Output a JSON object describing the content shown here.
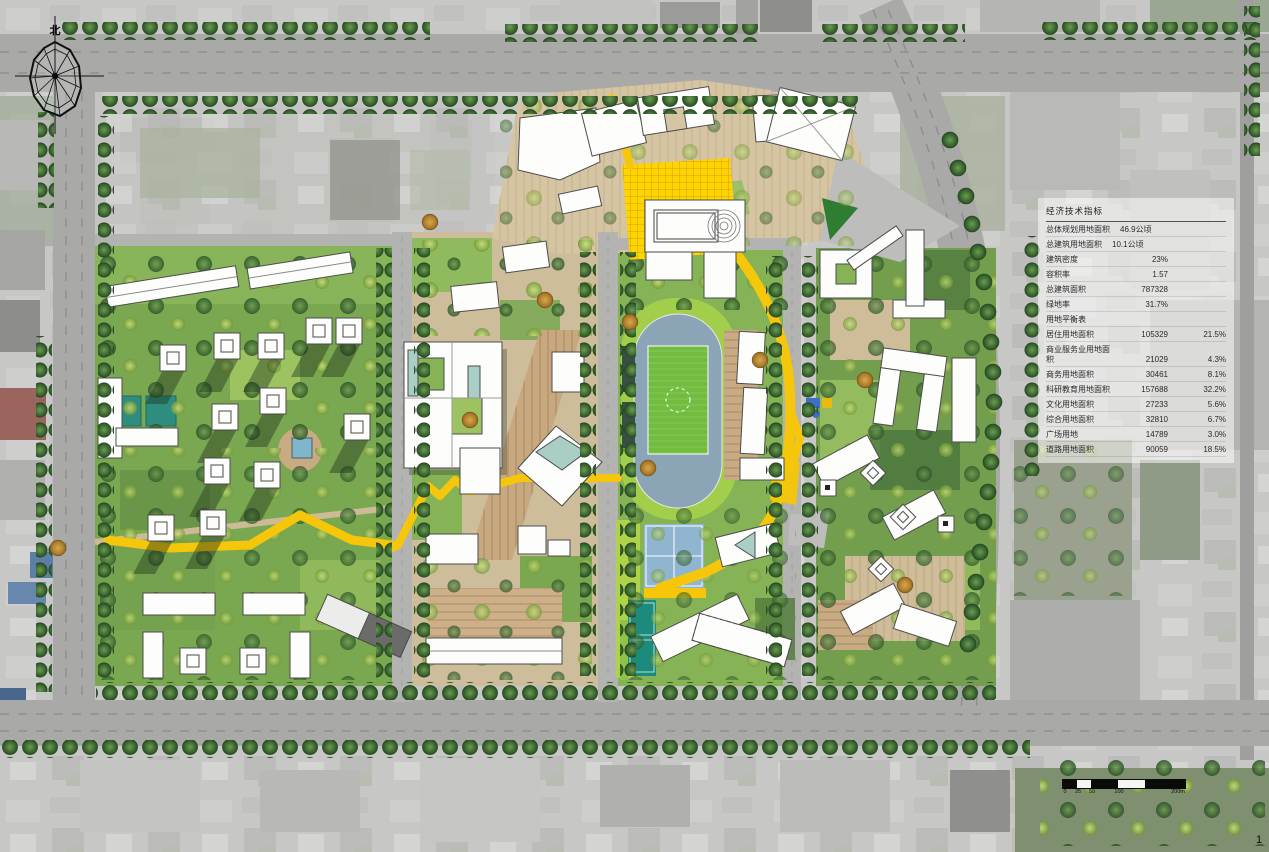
{
  "table": {
    "header": "经济技术指标",
    "rows": [
      {
        "label": "总体规划用地面积",
        "value": "46.9公顷",
        "pct": ""
      },
      {
        "label": "总建筑用地面积",
        "value": "10.1公顷",
        "pct": ""
      },
      {
        "label": "建筑密度",
        "value": "23%",
        "pct": ""
      },
      {
        "label": "容积率",
        "value": "1.57",
        "pct": ""
      },
      {
        "label": "总建筑面积",
        "value": "787328",
        "pct": ""
      },
      {
        "label": "绿地率",
        "value": "31.7%",
        "pct": ""
      },
      {
        "label": "用地平衡表",
        "value": "",
        "pct": ""
      },
      {
        "label": "居住用地面积",
        "value": "105329",
        "pct": "21.5%"
      },
      {
        "label": "商业服务业用地面积",
        "value": "21029",
        "pct": "4.3%"
      },
      {
        "label": "商务用地面积",
        "value": "30461",
        "pct": "8.1%"
      },
      {
        "label": "科研教育用地面积",
        "value": "157688",
        "pct": "32.2%"
      },
      {
        "label": "文化用地面积",
        "value": "27233",
        "pct": "5.6%"
      },
      {
        "label": "综合用地面积",
        "value": "32810",
        "pct": "6.7%"
      },
      {
        "label": "广场用地",
        "value": "14789",
        "pct": "3.0%"
      },
      {
        "label": "道路用地面积",
        "value": "90059",
        "pct": "18.5%"
      }
    ]
  },
  "compass": {
    "label": "北"
  },
  "scalebar": {
    "labels": [
      "0",
      "25",
      "50",
      "100",
      "200m"
    ]
  },
  "corner_mark": "1",
  "palette": {
    "aerial_gray": "#c7c7c5",
    "road": "#a9a9a7",
    "inner_road": "#b3b3b1",
    "lawn": "#7aa851",
    "bright_lawn": "#9ccb45",
    "plaza_tan": "#d6c5a2",
    "wood_deck": "#c8a97f",
    "path_yellow": "#f6c60a",
    "track_blue": "#8ba5b7",
    "field_green": "#72bd3f",
    "court_blue": "#8fb5d0",
    "court_teal": "#1d8b7c",
    "tree_dark": "#3e6b33",
    "tree_light": "#96b94e",
    "building_white": "#fdfdfc"
  }
}
